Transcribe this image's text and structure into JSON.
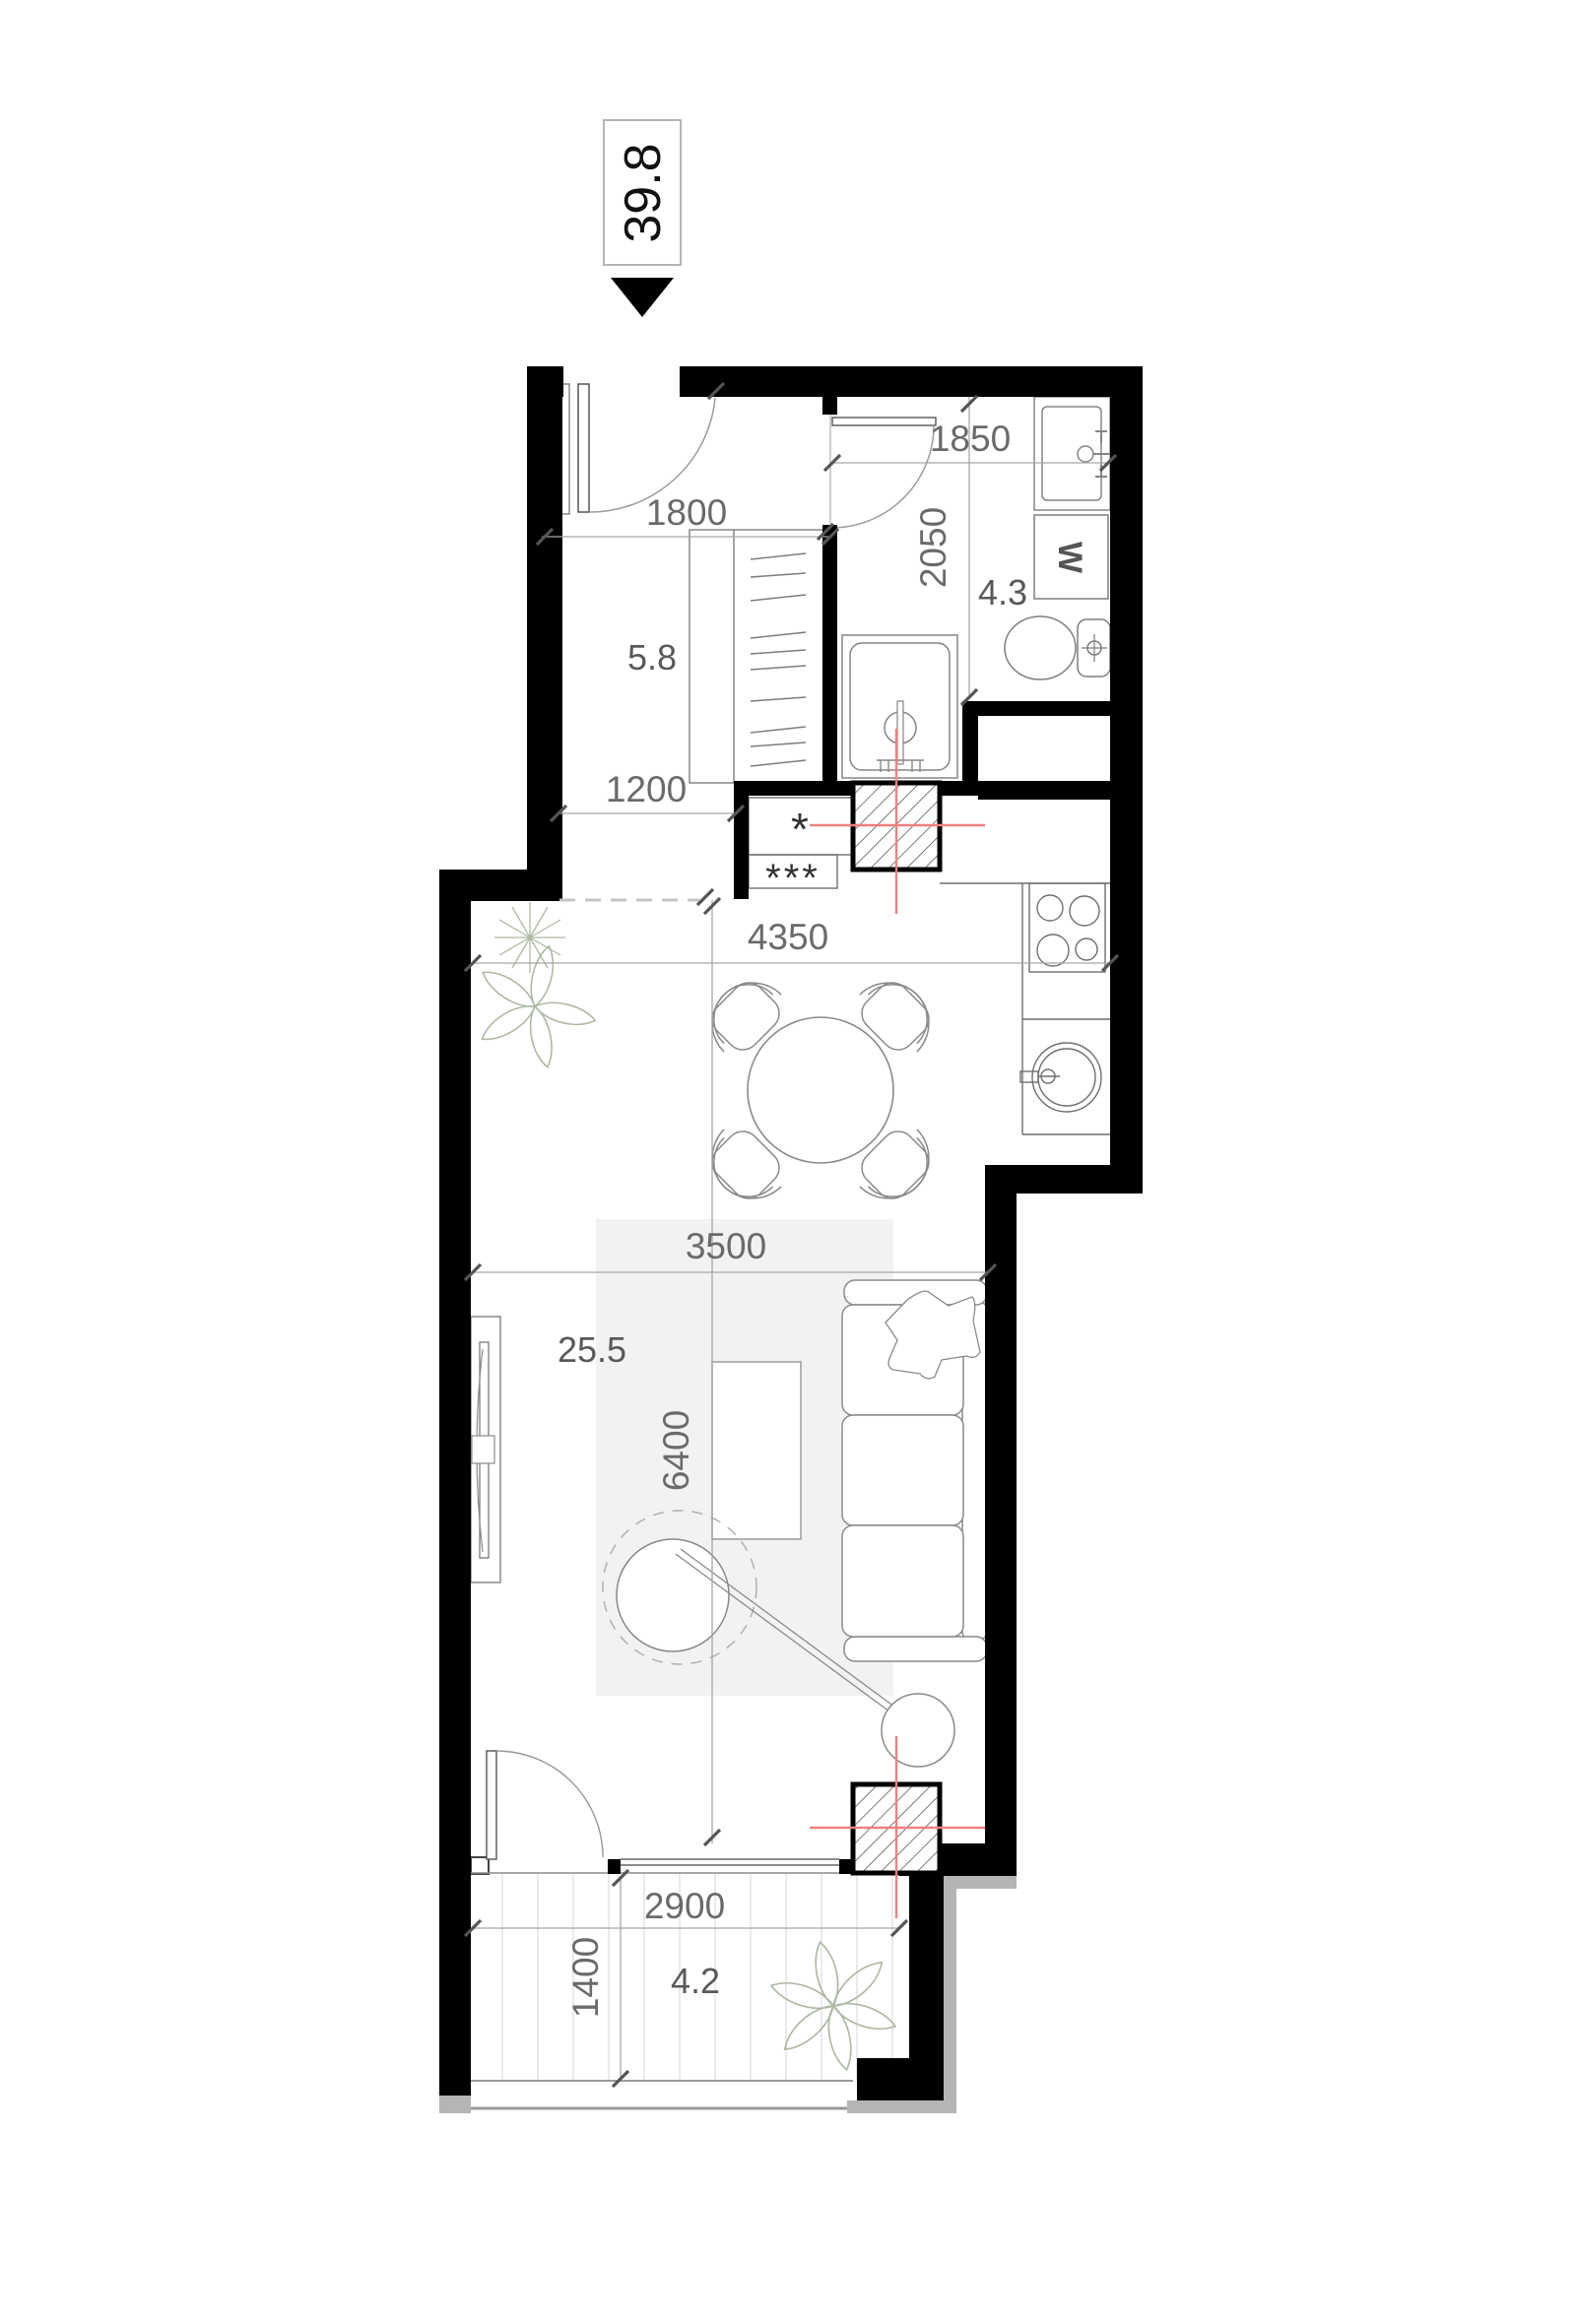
{
  "meta": {
    "type": "apartment-floor-plan"
  },
  "header": {
    "unit_area": "39.8"
  },
  "rooms": {
    "hall": {
      "area": "5.8"
    },
    "bathroom": {
      "area": "4.3"
    },
    "living": {
      "area": "25.5"
    },
    "balcony": {
      "area": "4.2"
    }
  },
  "dimensions": {
    "entry_width": "1800",
    "bath_width": "1850",
    "bath_depth": "2050",
    "hall_passage": "1200",
    "kitchen_dining_width": "4350",
    "living_width": "3500",
    "living_depth": "6400",
    "balcony_width": "2900",
    "balcony_depth": "1400"
  },
  "fixtures": {
    "washing_machine": "W",
    "kitchen_symbol_single": "*",
    "kitchen_symbol_triple": "***"
  },
  "colors": {
    "wall": "#000000",
    "dimension_text": "#6a6a6a",
    "utility_line_red": "#f08080",
    "rug": "#f2f2f2",
    "plant_stroke": "#aeb9a4",
    "slab_gray": "#b5b5b5"
  }
}
